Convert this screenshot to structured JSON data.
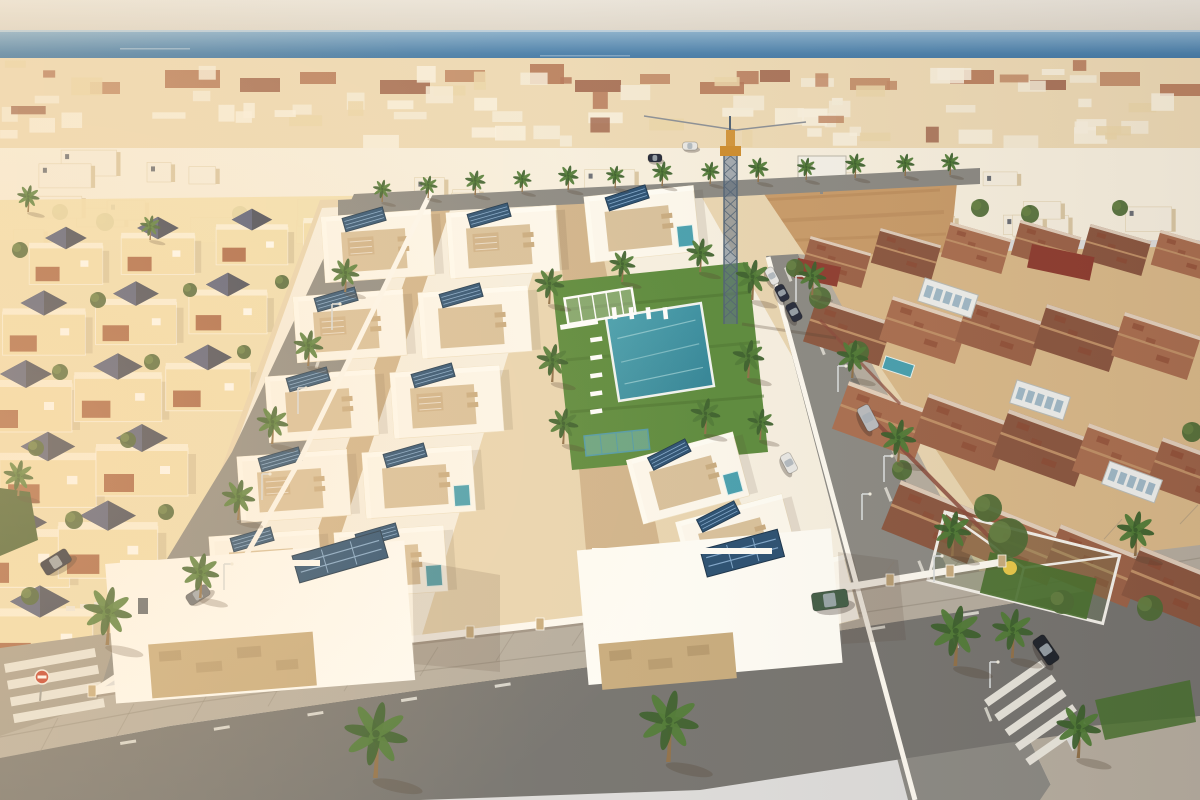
{
  "image": {
    "kind": "aerial-3d-architectural-render",
    "subject": "New development of white flat-roof villas with solar panels and a communal lawn/pool, flanked by an older cream villa district (left) and terracotta-roofed townhouses (right), dense Mediterranean town and blue sea on the horizon, warm low sunlight from the left"
  },
  "palette": {
    "sky_top": "#eae5dc",
    "sky_low": "#ddd6ca",
    "sea_top": "#8db3cf",
    "sea_mid": "#4a80ac",
    "sea_deep": "#2a5f90",
    "horizon": "#b9cedd",
    "pier": "#3d5c78",
    "haze": "#ecd9b4",
    "town_white": "#f7f0e0",
    "town_cream": "#e9d3a4",
    "terracotta": "#a55c3e",
    "terra_dark": "#8c4832",
    "terra_light": "#b4724f",
    "slate": "#3c4356",
    "slate_light": "#4f597a",
    "sand": "#c89b69",
    "dirt_streak": "#b8895a",
    "left_wall": "#f2e0af",
    "patio_red": "#a05538",
    "dev_base": "#e9d6b2",
    "alley": "#d0b48c",
    "deck": "#d8c19c",
    "pergola": "#cdb188",
    "white": "#fffef8",
    "unit_white": "#fdf9ef",
    "solar": "#274e72",
    "solar_stripe": "#7fa7cc",
    "lawn": "#5a8a3c",
    "lawn_dark": "#47702e",
    "palm": "#4e7a36",
    "palm_dark": "#3a5f2c",
    "trunk": "#8f7049",
    "pool": "#46a0b0",
    "pool_deep": "#2f8397",
    "road": "#8a8984",
    "road_dark": "#747370",
    "sidewalk": "#b5ada0",
    "paver_line": "#8d8578",
    "stone": "#c8ac7e",
    "stone_dark": "#a88c62",
    "roof_a": "#9b6248",
    "roof_b": "#8a5640",
    "roof_c": "#a96e50",
    "ridge": "#c09067",
    "gable": "#f3ead8",
    "brick": "#8a4a3c",
    "crane_steel": "#4d6074",
    "crane_fill": "#5b7088",
    "crane_yellow": "#cd8c2d",
    "tree": "#4c6a34",
    "hedge": "#3f5a2e",
    "car_dark": "#23293a",
    "car_black": "#1d222b",
    "car_white": "#e8e8e6",
    "car_silver": "#b9bcc0",
    "car_green": "#3f5c46",
    "car_gray": "#6a6f75",
    "zebra": "#eceae2",
    "sign_red": "#c43b2a",
    "shadow": "rgba(80,60,45,0.28)",
    "glow": "rgba(255,205,150,0.20)",
    "warm": "rgba(255,222,170,0.16)"
  },
  "scene": {
    "sea": {
      "horizon_y": 30,
      "bottom_y": 82
    },
    "crane": {
      "x": 730,
      "top_y": 116,
      "base_y": 322
    },
    "billboard": {
      "x": 800,
      "y": 158,
      "w": 46,
      "h": 20
    },
    "pool": {
      "cx": 660,
      "cy": 352,
      "w": 96,
      "h": 84,
      "angle": -9
    },
    "lawn_points": "552,282 748,262 768,452 572,470",
    "palms": [
      [
        375,
        778,
        1.7
      ],
      [
        668,
        762,
        1.6
      ],
      [
        955,
        666,
        1.35
      ],
      [
        107,
        645,
        1.3
      ],
      [
        1135,
        556,
        1.0
      ],
      [
        812,
        295,
        0.75
      ],
      [
        852,
        378,
        0.85
      ],
      [
        898,
        462,
        0.95
      ],
      [
        952,
        556,
        1.0
      ],
      [
        1012,
        658,
        1.1
      ],
      [
        1078,
        758,
        1.2
      ],
      [
        345,
        292,
        0.75
      ],
      [
        308,
        366,
        0.8
      ],
      [
        272,
        444,
        0.85
      ],
      [
        238,
        520,
        0.9
      ],
      [
        200,
        598,
        1.0
      ],
      [
        382,
        202,
        0.5
      ],
      [
        428,
        198,
        0.5
      ],
      [
        475,
        195,
        0.55
      ],
      [
        522,
        192,
        0.5
      ],
      [
        568,
        190,
        0.55
      ],
      [
        615,
        188,
        0.5
      ],
      [
        662,
        186,
        0.55
      ],
      [
        710,
        184,
        0.5
      ],
      [
        758,
        182,
        0.55
      ],
      [
        806,
        180,
        0.5
      ],
      [
        855,
        178,
        0.55
      ],
      [
        905,
        176,
        0.5
      ],
      [
        950,
        175,
        0.5
      ],
      [
        549,
        304,
        0.8
      ],
      [
        552,
        382,
        0.85
      ],
      [
        563,
        444,
        0.8
      ],
      [
        752,
        300,
        0.9
      ],
      [
        748,
        378,
        0.85
      ],
      [
        705,
        434,
        0.8
      ],
      [
        622,
        282,
        0.7
      ],
      [
        700,
        272,
        0.75
      ],
      [
        760,
        440,
        0.7
      ],
      [
        28,
        212,
        0.6
      ],
      [
        150,
        240,
        0.55
      ],
      [
        18,
        496,
        0.8
      ]
    ],
    "left_villas": [
      [
        66,
        262,
        0.8
      ],
      [
        158,
        252,
        0.8
      ],
      [
        252,
        243,
        0.78
      ],
      [
        338,
        236,
        0.75
      ],
      [
        44,
        330,
        0.9
      ],
      [
        136,
        320,
        0.88
      ],
      [
        228,
        310,
        0.85
      ],
      [
        26,
        404,
        1.0
      ],
      [
        118,
        395,
        0.95
      ],
      [
        208,
        385,
        0.92
      ],
      [
        48,
        478,
        1.05
      ],
      [
        142,
        468,
        1.0
      ],
      [
        18,
        556,
        1.12
      ],
      [
        108,
        548,
        1.08
      ],
      [
        40,
        636,
        1.15
      ]
    ],
    "dev_units": [
      [
        378,
        246,
        -4,
        0,
        1
      ],
      [
        350,
        326,
        -4,
        0,
        1
      ],
      [
        322,
        406,
        -4,
        0,
        0
      ],
      [
        294,
        486,
        -4,
        0,
        1
      ],
      [
        266,
        566,
        -4,
        0,
        0
      ],
      [
        503,
        242,
        -4,
        0,
        1
      ],
      [
        475,
        322,
        -4,
        0,
        0
      ],
      [
        447,
        402,
        -4,
        0,
        1
      ],
      [
        419,
        482,
        -4,
        1,
        0
      ],
      [
        391,
        562,
        -4,
        1,
        0
      ],
      [
        642,
        224,
        -6,
        1,
        0
      ],
      [
        688,
        478,
        -15,
        1,
        0
      ],
      [
        737,
        540,
        -15,
        1,
        0
      ],
      [
        798,
        600,
        -14,
        0,
        0
      ]
    ],
    "right_roofs": [
      [
        836,
        262,
        0.75,
        16,
        0
      ],
      [
        906,
        254,
        0.75,
        16,
        1
      ],
      [
        976,
        248,
        0.75,
        16,
        2
      ],
      [
        1046,
        246,
        0.75,
        16,
        0
      ],
      [
        1116,
        250,
        0.75,
        16,
        1
      ],
      [
        1186,
        256,
        0.75,
        16,
        2
      ],
      [
        848,
        332,
        0.95,
        18,
        1
      ],
      [
        924,
        330,
        0.95,
        18,
        2
      ],
      [
        1000,
        332,
        0.95,
        18,
        0
      ],
      [
        1078,
        338,
        0.95,
        18,
        1
      ],
      [
        1156,
        346,
        0.95,
        18,
        2
      ],
      [
        882,
        420,
        1.05,
        20,
        2
      ],
      [
        962,
        432,
        1.05,
        20,
        0
      ],
      [
        1042,
        448,
        1.05,
        20,
        1
      ],
      [
        1122,
        462,
        1.05,
        20,
        2
      ],
      [
        1196,
        476,
        1.05,
        20,
        0
      ],
      [
        934,
        522,
        1.1,
        22,
        1
      ],
      [
        1014,
        544,
        1.1,
        22,
        2
      ],
      [
        1094,
        566,
        1.1,
        22,
        0
      ],
      [
        1174,
        588,
        1.1,
        22,
        1
      ]
    ],
    "conservatories": [
      [
        948,
        298,
        18
      ],
      [
        1040,
        400,
        18
      ],
      [
        1132,
        482,
        20
      ]
    ],
    "flat_red_roofs": [
      [
        1032,
        244,
        64,
        24
      ],
      [
        798,
        258,
        44,
        20
      ]
    ],
    "right_trees": [
      [
        820,
        298,
        11
      ],
      [
        858,
        352,
        11
      ],
      [
        795,
        268,
        9
      ],
      [
        1008,
        538,
        20
      ],
      [
        988,
        508,
        14
      ],
      [
        1150,
        608,
        13
      ],
      [
        1062,
        602,
        12
      ],
      [
        902,
        470,
        10
      ],
      [
        1192,
        432,
        10
      ]
    ],
    "left_bushes": [
      [
        20,
        250,
        8
      ],
      [
        98,
        300,
        8
      ],
      [
        190,
        290,
        7
      ],
      [
        282,
        282,
        7
      ],
      [
        60,
        372,
        8
      ],
      [
        152,
        362,
        8
      ],
      [
        244,
        352,
        7
      ],
      [
        36,
        448,
        8
      ],
      [
        128,
        440,
        8
      ],
      [
        74,
        520,
        9
      ],
      [
        166,
        512,
        8
      ],
      [
        30,
        596,
        9
      ]
    ],
    "mid_trees": [
      [
        60,
        212,
        8
      ],
      [
        105,
        222,
        9
      ],
      [
        240,
        214,
        8
      ],
      [
        330,
        208,
        7
      ],
      [
        470,
        210,
        7
      ],
      [
        520,
        205,
        8
      ],
      [
        600,
        200,
        7
      ],
      [
        645,
        222,
        12
      ],
      [
        668,
        230,
        10
      ],
      [
        760,
        190,
        7
      ],
      [
        980,
        208,
        9
      ],
      [
        1030,
        214,
        9
      ],
      [
        1120,
        208,
        8
      ]
    ],
    "cars": [
      [
        690,
        146,
        15,
        8,
        0,
        "car_white"
      ],
      [
        655,
        158,
        14,
        8,
        0,
        "car_dark"
      ],
      [
        772,
        276,
        18,
        9,
        62,
        "car_white"
      ],
      [
        782,
        293,
        17,
        10,
        62,
        "car_dark"
      ],
      [
        794,
        312,
        19,
        11,
        62,
        "car_dark"
      ],
      [
        789,
        463,
        20,
        11,
        62,
        "car_white"
      ],
      [
        868,
        418,
        26,
        13,
        62,
        "car_silver"
      ],
      [
        1046,
        650,
        30,
        14,
        55,
        "car_black"
      ],
      [
        56,
        562,
        30,
        15,
        -32,
        "car_dark"
      ],
      [
        198,
        595,
        24,
        12,
        -32,
        "car_gray"
      ],
      [
        830,
        600,
        36,
        18,
        -8,
        "car_green"
      ]
    ],
    "lamps": [
      [
        796,
        302
      ],
      [
        838,
        392
      ],
      [
        884,
        482
      ],
      [
        934,
        582
      ],
      [
        990,
        688
      ],
      [
        332,
        330
      ],
      [
        298,
        414
      ],
      [
        262,
        500
      ],
      [
        224,
        590
      ],
      [
        862,
        520
      ]
    ],
    "loungers_col": {
      "x": 590,
      "y0": 338,
      "step": 18,
      "n": 5,
      "angle": -8
    },
    "loungers_row": {
      "x0": 616,
      "y": 307,
      "step": 17,
      "n": 4,
      "angle": 84
    },
    "zebra_left": {
      "x": 4,
      "y": 664,
      "angle": -10,
      "n": 4,
      "len": 92,
      "step": 17
    },
    "zebra_right": {
      "x": 984,
      "y": 700,
      "angle": -35,
      "n": 5,
      "len": 70,
      "step": 18
    },
    "wall_piers": [
      [
        92,
        692
      ],
      [
        160,
        682
      ],
      [
        228,
        671
      ],
      [
        268,
        656
      ],
      [
        330,
        649
      ],
      [
        400,
        641
      ],
      [
        470,
        633
      ],
      [
        540,
        625
      ],
      [
        610,
        617
      ],
      [
        680,
        608
      ],
      [
        750,
        599
      ],
      [
        820,
        590
      ],
      [
        890,
        581
      ],
      [
        950,
        572
      ],
      [
        1002,
        562
      ]
    ],
    "stop_sign": {
      "x": 42,
      "y": 677
    }
  }
}
